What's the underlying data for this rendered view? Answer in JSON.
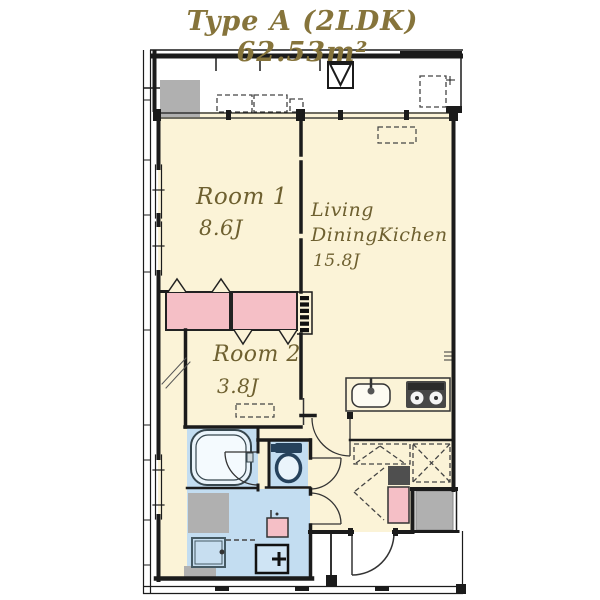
{
  "title": "Type A (2LDK) 62.53m²",
  "rooms": {
    "room1": {
      "name": "Room 1",
      "size": "8.6J"
    },
    "ldk": {
      "name_line1": "Living",
      "name_line2": "DiningKichen",
      "size": "15.8J"
    },
    "room2": {
      "name": "Room 2",
      "size": "3.8J"
    }
  },
  "colors": {
    "bg": "#FFFFFF",
    "cream": "#FBF3D7",
    "pink": "#F5BFC6",
    "blue": "#C3DDF1",
    "bluelight": "#EAF4FB",
    "gray": "#B0B0B0",
    "graydark": "#4F4F4F",
    "wall": "#1B1B1B",
    "label": "#6E6030",
    "title": "#86743B"
  },
  "icons": {
    "bathtub": "rounded-rect-double",
    "toilet": "tank-and-bowl",
    "kitchen-sink": "rounded-rect-faucet",
    "gas-stove": "dark-panel-burners",
    "washbasin": "square-cross",
    "washing-machine-pan": "square-drain-dot",
    "water-heater": "small-pink-box",
    "shoe-cabinet": "pink-box",
    "ac-outdoor-unit": "gray-box",
    "vent": "square-with-triangle",
    "pipe-space": "comb-hatch",
    "closet-door": "fold-peak-marks"
  }
}
